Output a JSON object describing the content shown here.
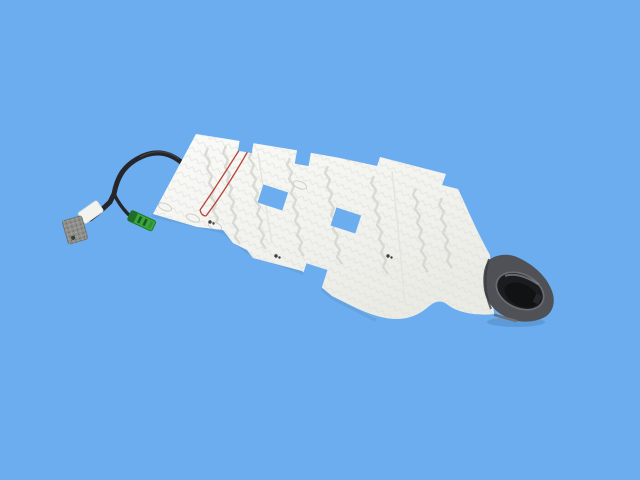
{
  "scene": {
    "kind": "product-photo",
    "subject": "seat heater element pad with wiring harness and rubber end boot",
    "background_style": "solid blue backdrop",
    "text_content": ""
  },
  "colors": {
    "background": "#6CADEF",
    "pad_light": "#FBFBF9",
    "pad_dark": "#EBEBE6",
    "heater_trace": "#D4D4CF",
    "chevron_texture": "#DCDCD7",
    "seam": "#E4E4DF",
    "sensor_wire_red": "#B8453A",
    "cable_black": "#26262A",
    "cable_highlight": "#55555E",
    "connector_gray": "#8F8F8C",
    "connector_gray_speckle": "#5F5F5C",
    "connector_green": "#3AA33E",
    "connector_green_dark": "#1E7D26",
    "tape_white": "#F2F2EE",
    "boot_body": "#505156",
    "boot_rim": "#6A6B71",
    "boot_opening": "#1B1C1F",
    "boot_inner": "#0F1012",
    "speck_dark": "#3F3F3D",
    "shadow_blue": "#5D96CF"
  }
}
